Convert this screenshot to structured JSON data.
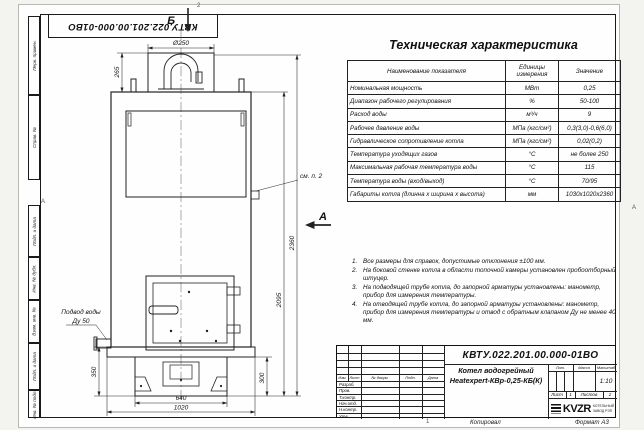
{
  "doc": {
    "number": "КВТУ.022.201.00.000-01ВО",
    "copied": "Копировал",
    "format": "Формат А3",
    "zone_top": "2",
    "zone_bottom": "1",
    "zone_row": "А"
  },
  "margin_labels": [
    "Перв. примен.",
    "Справ. №",
    "Подп. и дата",
    "Инв. № дубл.",
    "Взам. инв. №",
    "Подп. и дата",
    "Инв. № подл."
  ],
  "spec_table": {
    "title": "Техническая характеристика",
    "header": {
      "name": "Наименование показателя",
      "unit": "Единицы измерения",
      "value": "Значение"
    },
    "rows": [
      {
        "name": "Номинальная мощность",
        "unit": "МВт",
        "value": "0,25"
      },
      {
        "name": "Диапазон рабочего регулирования",
        "unit": "%",
        "value": "50-100"
      },
      {
        "name": "Расход воды",
        "unit": "м³/ч",
        "value": "9"
      },
      {
        "name": "Рабочее давление воды",
        "unit": "МПа (кгс/см²)",
        "value": "0,3(3,0)-0,6(6,0)"
      },
      {
        "name": "Гидравлическое сопротивление котла",
        "unit": "МПа (кгс/см²)",
        "value": "0,02(0,2)"
      },
      {
        "name": "Температура уходящих газов",
        "unit": "°С",
        "value": "не более 250"
      },
      {
        "name": "Максимальная рабочая температура воды",
        "unit": "°С",
        "value": "115"
      },
      {
        "name": "Температура воды (вход/выход)",
        "unit": "°С",
        "value": "70/95"
      },
      {
        "name": "Габариты котла (длинна х ширина х высота)",
        "unit": "мм",
        "value": "1030х1020х2360"
      }
    ]
  },
  "notes": [
    {
      "num": "1.",
      "text": "Все размеры для справок, допустимые отклонения ±100 мм."
    },
    {
      "num": "2.",
      "text": "На боковой стенке котла в области топочной камеры установлен пробоотборный штуцер."
    },
    {
      "num": "3.",
      "text": "На подводящей трубе котла, до запорной арматуры установлены: манометр, прибор для измерения температуры."
    },
    {
      "num": "4.",
      "text": "На отводящей трубе котла, до запорной арматуры установлены: манометр, прибор для измерения температуры и отвод с обратным клапаном Ду не менее 40 мм."
    }
  ],
  "drawing": {
    "view_b": "Б",
    "view_a": "А",
    "callout_see_note": "см. п. 2",
    "water_inlet_line1": "Подвод воды",
    "water_inlet_line2": "Ду 50",
    "dims": {
      "d250": "Ø250",
      "h265": "265",
      "h2095": "2095",
      "h2360": "2360",
      "h350": "350",
      "h300": "300",
      "w640": "640",
      "w1020": "1020"
    }
  },
  "stamp": {
    "doc_number": "КВТУ.022.201.00.000-01ВО",
    "title_line1": "Котел водогрейный",
    "title_line2": "Heatexpert-КВр-0,25-КБ(К)",
    "cols": {
      "izm": "Изм.",
      "list": "Лист",
      "ndocum": "№ докум.",
      "podp": "Подп.",
      "data": "Дата"
    },
    "roles": [
      "Разраб.",
      "Пров.",
      "Т.контр.",
      "Нач.отд.",
      "Н.контр.",
      "Утв."
    ],
    "lit": "Лит.",
    "massa": "Масса",
    "masshtab": "Масштаб",
    "scale": "1:10",
    "sheet_label": "Лист",
    "sheet_num": "1",
    "sheets_label": "Листов",
    "sheets_num": "2",
    "logo_text": "KVZR",
    "logo_sub1": "КОТЕЛЬНЫЙ",
    "logo_sub2": "ЗАВОД РЭП"
  }
}
